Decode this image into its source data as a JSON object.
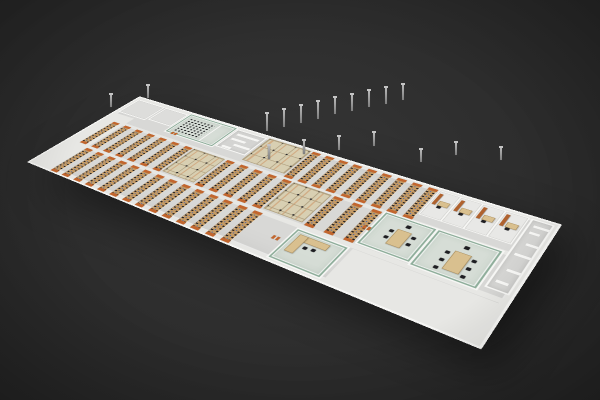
{
  "meta": {
    "alt": "3D isometric rendering of an open-plan office floor with desk rows, cubicle clusters, glass conference rooms, private offices and service cores on a dark grey background"
  },
  "palette": {
    "bg": "#2c2c2c",
    "floor": "#d8d8d6",
    "wall": "#f6f6f4",
    "corridor": "#e7e7e4",
    "core": "#d4d4d2",
    "glassframe": "#8fae9b",
    "glassfill": "rgba(213,228,216,0.45)",
    "deskwood": "#c49a64",
    "deskbeige": "#d9c08f",
    "chair": "#1e1e22",
    "orange": "#c2662e",
    "blue": "#2f5fc0",
    "cubiclebase": "#d8cfb2",
    "cubicleline": "#b2a383",
    "officefloor": "#e8e8e6",
    "cabinet": "#b0622e",
    "pole": "#9a9a9a"
  },
  "scene": {
    "floor": {
      "w": 900,
      "h": 300
    },
    "zones": [
      {
        "type": "corridor",
        "name": "corridor-north",
        "x": 0,
        "y": 99,
        "w": 900,
        "h": 10
      },
      {
        "type": "corridor",
        "name": "corridor-south",
        "x": 0,
        "y": 200,
        "w": 900,
        "h": 11
      },
      {
        "type": "plain-light",
        "name": "west-open-area",
        "x": 6,
        "y": 76,
        "w": 52,
        "h": 218
      },
      {
        "type": "plain-light",
        "name": "se-open-area",
        "x": 660,
        "y": 212,
        "w": 234,
        "h": 84
      },
      {
        "type": "room-outline",
        "name": "west-room-1",
        "x": 6,
        "y": 8,
        "w": 76,
        "h": 62
      },
      {
        "type": "room-outline",
        "name": "west-room-2",
        "x": 86,
        "y": 8,
        "w": 62,
        "h": 56
      },
      {
        "type": "glass-room",
        "name": "conference-room",
        "x": 152,
        "y": 4,
        "w": 120,
        "h": 78,
        "items": [
          {
            "cls": "chair-grid",
            "name": "training-chairs",
            "x": 8,
            "y": 10,
            "w": 66,
            "h": 56
          },
          {
            "cls": "wall-seg",
            "name": "glass-partition",
            "x": 80,
            "y": 0,
            "w": 3,
            "h": 72
          },
          {
            "cls": "door-pair",
            "name": "conference-doors",
            "x": 12,
            "y": 70,
            "w": 14,
            "h": 8
          }
        ]
      },
      {
        "type": "core-maze",
        "name": "core-maze-west",
        "x": 276,
        "y": 6,
        "w": 72,
        "h": 72,
        "bars": [
          [
            8,
            10,
            52,
            7
          ],
          [
            8,
            28,
            34,
            7
          ],
          [
            26,
            44,
            38,
            7
          ],
          [
            8,
            58,
            22,
            7
          ]
        ]
      },
      {
        "type": "cubicle-grid",
        "name": "cubicle-block-a",
        "x": 352,
        "y": 4,
        "w": 96,
        "h": 88,
        "cell": 30
      },
      {
        "type": "desk-bank",
        "name": "desk-bank-top",
        "x": 452,
        "y": 6,
        "w": 248,
        "h": 92,
        "rows": 9,
        "rowW": 15
      },
      {
        "type": "office-row",
        "name": "private-offices",
        "x": 704,
        "y": 4,
        "w": 152,
        "h": 74,
        "count": 4
      },
      {
        "type": "core-maze",
        "name": "core-maze-east",
        "x": 860,
        "y": 4,
        "w": 36,
        "h": 186,
        "bars": [
          [
            6,
            12,
            24,
            6
          ],
          [
            6,
            30,
            16,
            6
          ],
          [
            12,
            60,
            18,
            6
          ],
          [
            6,
            90,
            24,
            6
          ],
          [
            10,
            130,
            20,
            6
          ],
          [
            6,
            160,
            18,
            6
          ]
        ]
      },
      {
        "type": "desk-bank",
        "name": "desk-bank-middle-west",
        "x": 30,
        "y": 108,
        "w": 212,
        "h": 90,
        "rows": 7,
        "rowW": 15
      },
      {
        "type": "cubicle-grid",
        "name": "cubicle-block-c",
        "x": 248,
        "y": 106,
        "w": 76,
        "h": 90,
        "cell": 26
      },
      {
        "type": "desk-bank",
        "name": "desk-bank-middle-center",
        "x": 330,
        "y": 108,
        "w": 142,
        "h": 90,
        "rows": 5,
        "rowW": 15
      },
      {
        "type": "cubicle-grid",
        "name": "cubicle-block-b",
        "x": 478,
        "y": 106,
        "w": 78,
        "h": 90,
        "cell": 26
      },
      {
        "type": "desk-bank",
        "name": "desk-bank-middle-east",
        "x": 562,
        "y": 108,
        "w": 88,
        "h": 90,
        "rows": 3,
        "rowW": 15
      },
      {
        "type": "glass-room",
        "name": "executive-office-1",
        "x": 658,
        "y": 104,
        "w": 88,
        "h": 92,
        "items": [
          {
            "cls": "wood-desk",
            "name": "executive-desk",
            "x": 34,
            "y": 26,
            "w": 22,
            "h": 40
          },
          {
            "cls": "chair-dot",
            "name": "guest-chair",
            "x": 24,
            "y": 32,
            "w": 7,
            "h": 7
          },
          {
            "cls": "chair-dot",
            "name": "guest-chair",
            "x": 24,
            "y": 50,
            "w": 7,
            "h": 7
          },
          {
            "cls": "chair-dot",
            "name": "guest-chair",
            "x": 62,
            "y": 32,
            "w": 7,
            "h": 7
          },
          {
            "cls": "chair-dot",
            "name": "guest-chair",
            "x": 62,
            "y": 50,
            "w": 7,
            "h": 7
          },
          {
            "cls": "chair-dot",
            "name": "executive-chair",
            "x": 42,
            "y": 10,
            "w": 8,
            "h": 8
          },
          {
            "cls": "door-pair",
            "name": "executive-doors",
            "x": -16,
            "y": 44,
            "w": 13,
            "h": 9
          }
        ]
      },
      {
        "type": "glass-room",
        "name": "executive-office-2",
        "x": 750,
        "y": 104,
        "w": 102,
        "h": 96,
        "items": [
          {
            "cls": "wood-desk",
            "name": "executive-desk",
            "x": 40,
            "y": 30,
            "w": 24,
            "h": 46
          },
          {
            "cls": "chair-dot",
            "name": "guest-chair",
            "x": 28,
            "y": 36,
            "w": 7,
            "h": 7
          },
          {
            "cls": "chair-dot",
            "name": "guest-chair",
            "x": 28,
            "y": 56,
            "w": 7,
            "h": 7
          },
          {
            "cls": "chair-dot",
            "name": "guest-chair",
            "x": 28,
            "y": 76,
            "w": 7,
            "h": 7
          },
          {
            "cls": "chair-dot",
            "name": "guest-chair",
            "x": 70,
            "y": 36,
            "w": 7,
            "h": 7
          },
          {
            "cls": "chair-dot",
            "name": "guest-chair",
            "x": 70,
            "y": 56,
            "w": 7,
            "h": 7
          },
          {
            "cls": "chair-dot",
            "name": "guest-chair",
            "x": 70,
            "y": 76,
            "w": 7,
            "h": 7
          },
          {
            "cls": "chair-dot",
            "name": "executive-chair",
            "x": 48,
            "y": 12,
            "w": 8,
            "h": 8
          }
        ]
      },
      {
        "type": "desk-bank",
        "name": "desk-bank-south",
        "x": 60,
        "y": 210,
        "w": 424,
        "h": 88,
        "rows": 14,
        "rowW": 15
      },
      {
        "type": "door-pair",
        "name": "south-doors",
        "x": 536,
        "y": 246,
        "w": 13,
        "h": 9
      },
      {
        "type": "glass-room",
        "name": "glass-meeting-room-south",
        "x": 560,
        "y": 214,
        "w": 92,
        "h": 80,
        "items": [
          {
            "cls": "wood-desk",
            "name": "meeting-desk",
            "x": 8,
            "y": 6,
            "w": 54,
            "h": 13
          },
          {
            "cls": "wood-desk",
            "name": "meeting-desk-return",
            "x": 8,
            "y": 6,
            "w": 14,
            "h": 44
          },
          {
            "cls": "chair-dot",
            "name": "meeting-chair",
            "x": 30,
            "y": 28,
            "w": 7,
            "h": 7
          },
          {
            "cls": "chair-dot",
            "name": "meeting-chair",
            "x": 44,
            "y": 26,
            "w": 7,
            "h": 7
          }
        ]
      }
    ],
    "poles": [
      {
        "x": 266,
        "y": 114,
        "h": 17
      },
      {
        "x": 283,
        "y": 110,
        "h": 17
      },
      {
        "x": 300,
        "y": 106,
        "h": 17
      },
      {
        "x": 317,
        "y": 102,
        "h": 17
      },
      {
        "x": 334,
        "y": 98,
        "h": 16
      },
      {
        "x": 351,
        "y": 95,
        "h": 16
      },
      {
        "x": 368,
        "y": 91,
        "h": 16
      },
      {
        "x": 385,
        "y": 88,
        "h": 16
      },
      {
        "x": 402,
        "y": 85,
        "h": 15
      },
      {
        "x": 147,
        "y": 86,
        "h": 12
      },
      {
        "x": 110,
        "y": 95,
        "h": 12
      },
      {
        "x": 268,
        "y": 146,
        "h": 13
      },
      {
        "x": 303,
        "y": 141,
        "h": 13
      },
      {
        "x": 338,
        "y": 137,
        "h": 13
      },
      {
        "x": 373,
        "y": 133,
        "h": 13
      },
      {
        "x": 420,
        "y": 150,
        "h": 12
      },
      {
        "x": 455,
        "y": 143,
        "h": 12
      },
      {
        "x": 500,
        "y": 148,
        "h": 12
      }
    ]
  }
}
